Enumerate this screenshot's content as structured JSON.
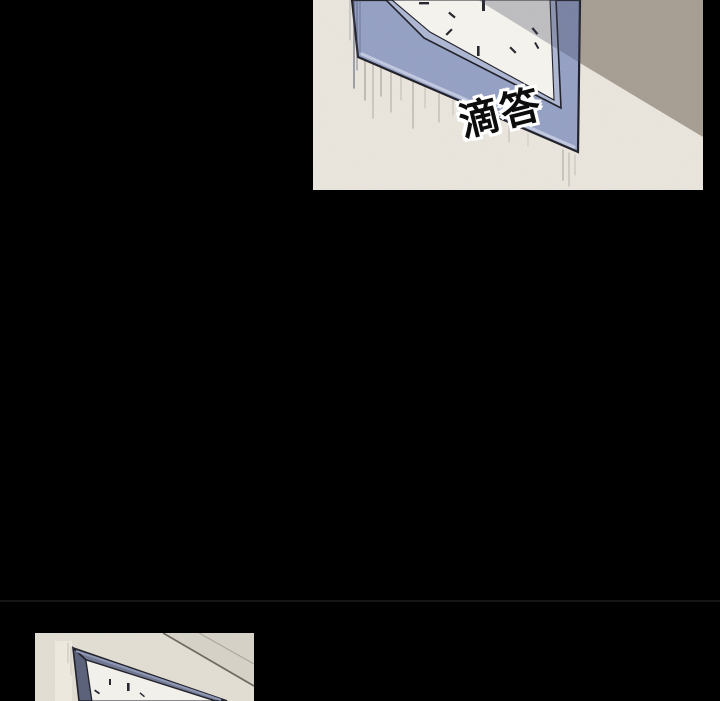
{
  "comic": {
    "sfx_top": "滴答"
  },
  "colors": {
    "page_bg": "#000000",
    "divider": "#161616",
    "outline": "#1d1d26",
    "p1_wall": "#eae6de",
    "p1_wall_shadow": "#a69d92",
    "p1_frame": "#94a0c4",
    "p1_bevel": "#aeb7d3",
    "p1_face": "#f6f4ee",
    "p1_shadow": "rgba(60,64,86,0.30)",
    "p1_highlight": "rgba(218,223,240,0.65)",
    "tick": "#23232b",
    "drip_gray": "#8a8478",
    "drip_dark": "#3a405c",
    "p2_wall": "#e2ded3",
    "p2_wall_dark": "#d6d2c7",
    "p2_line": "#6b665e",
    "p2_frame": "#6e7691",
    "p2_frame_left": "#585f78",
    "p2_bevel": "#8d96b3",
    "p2_face": "#f4f2ec",
    "p2_highlight": "rgba(240,236,226,0.85)",
    "sfx_fill": "#0d0d0d",
    "sfx_outline": "#ffffff"
  }
}
